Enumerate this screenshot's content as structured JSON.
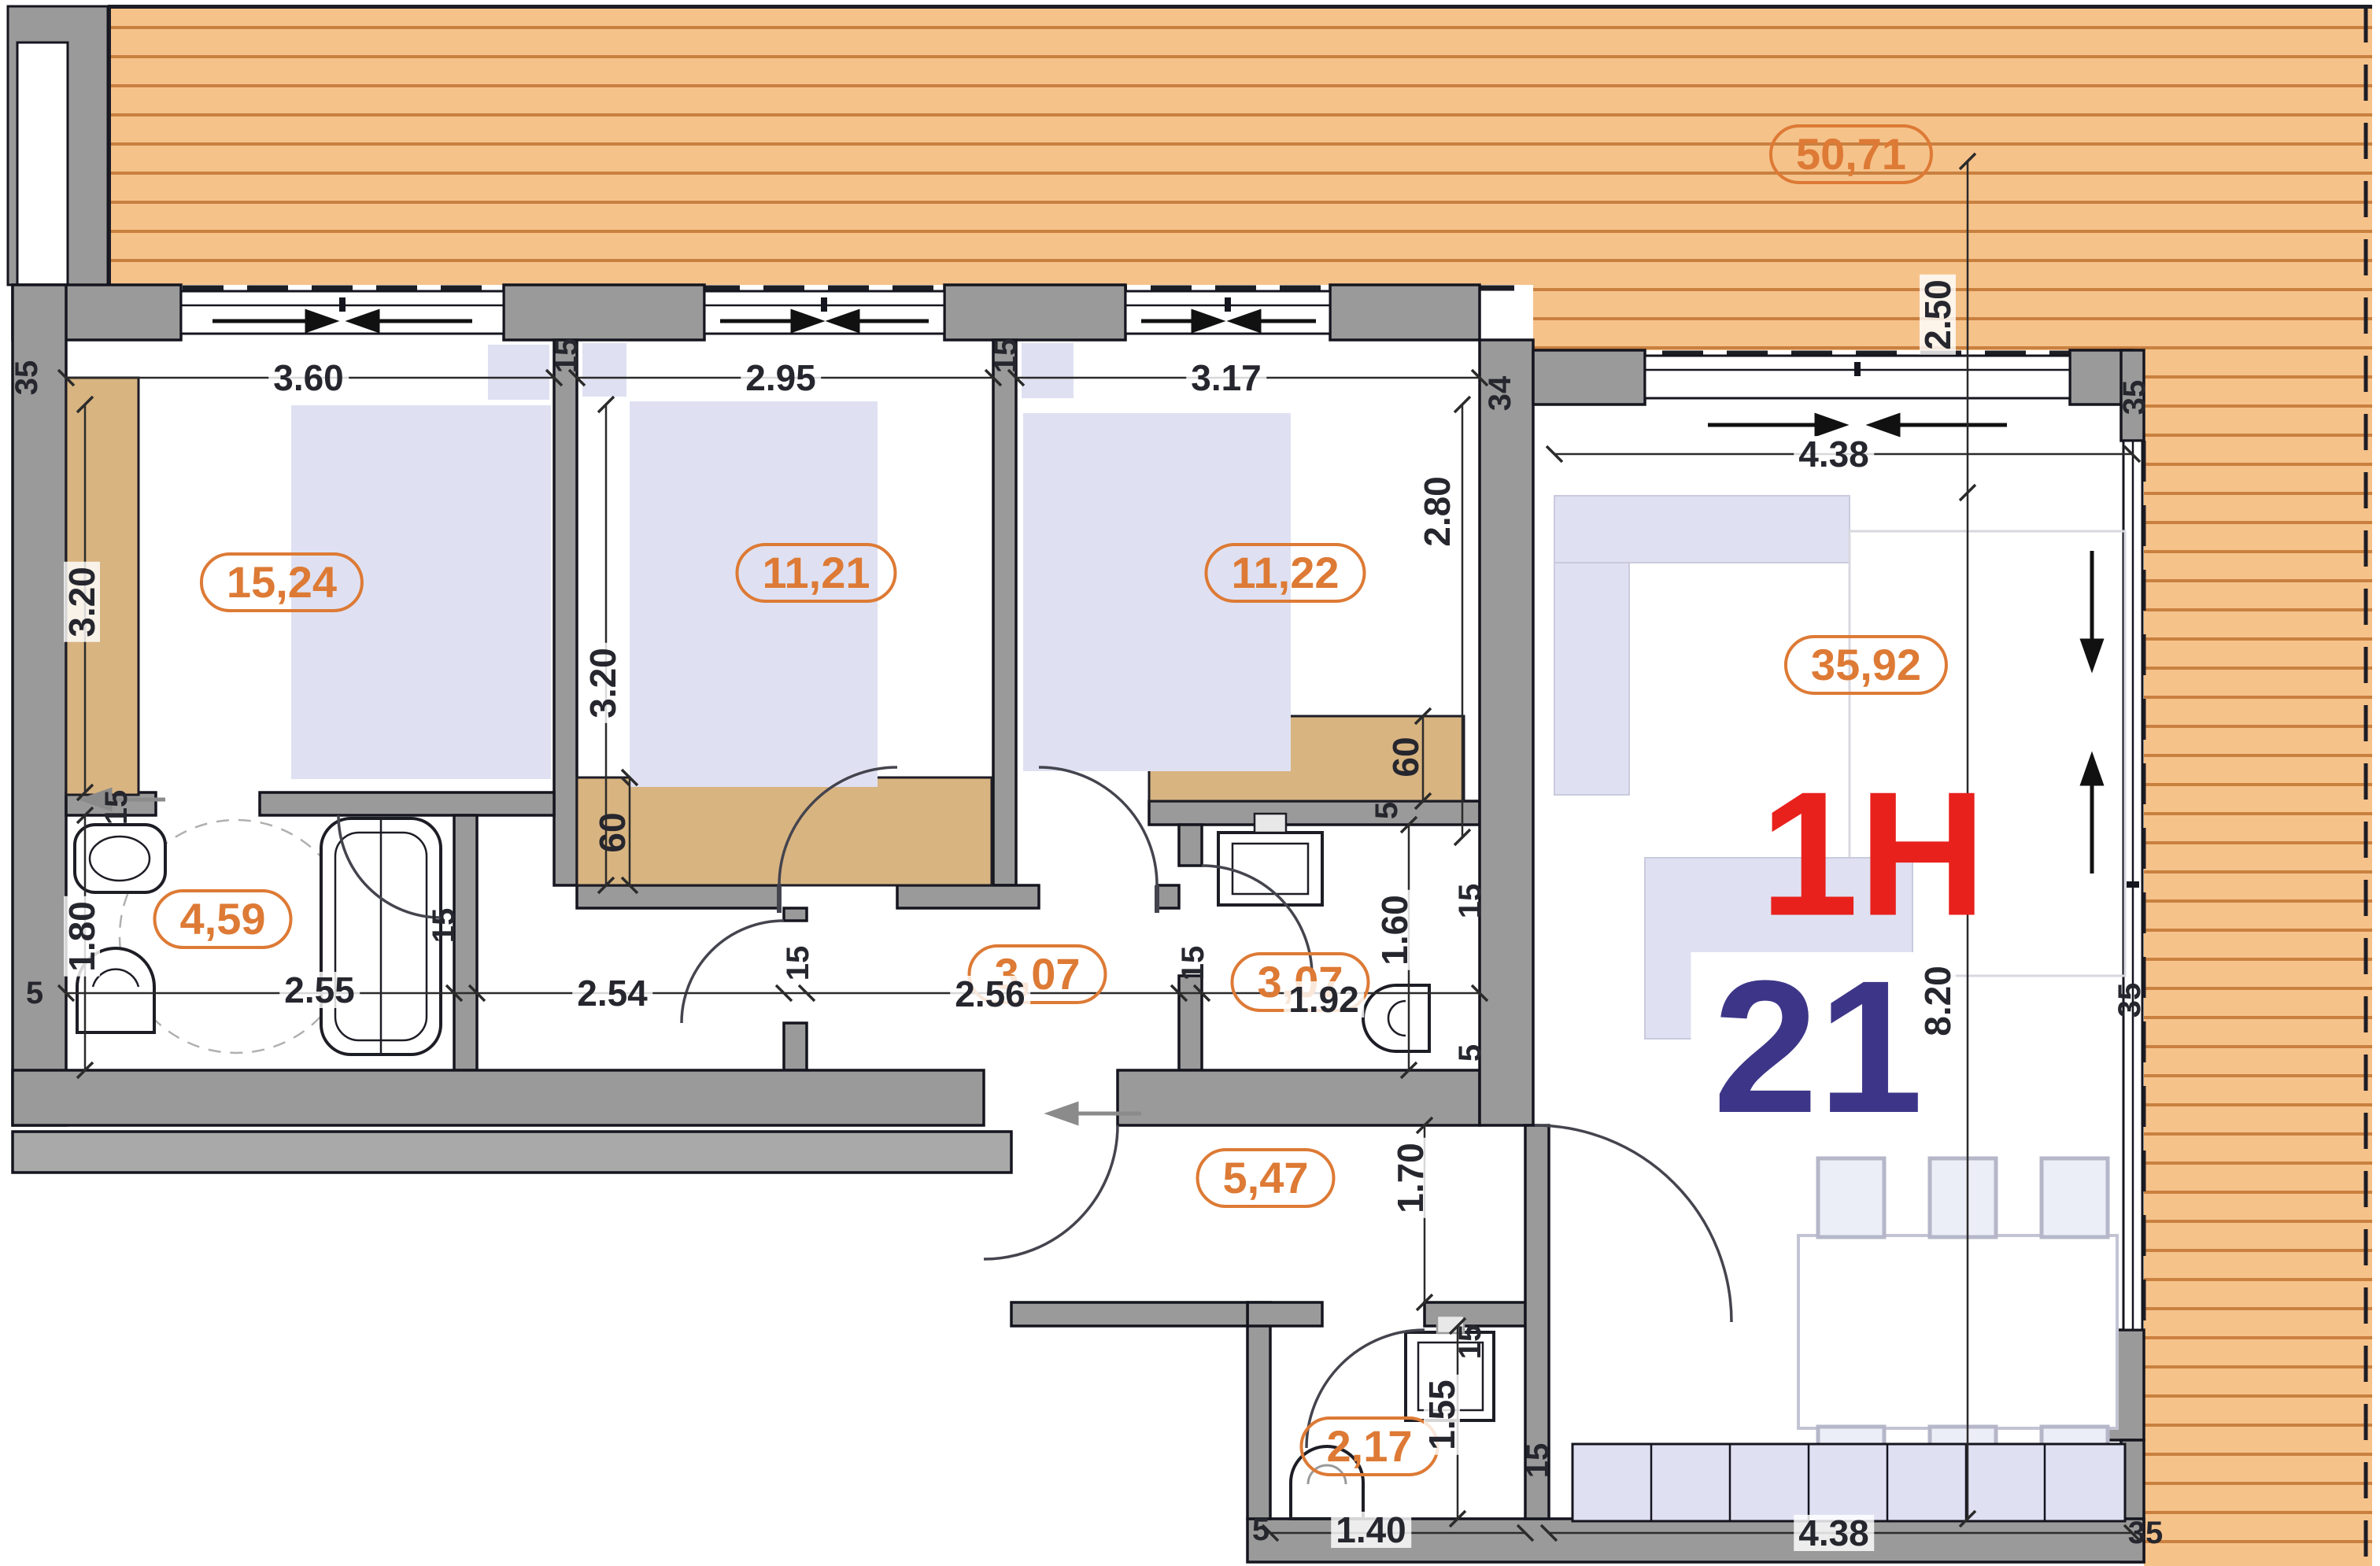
{
  "unit": {
    "type": "1H",
    "number": "21"
  },
  "areas": {
    "terrace": "50,71",
    "bedroom1": "15,24",
    "bedroom2": "11,21",
    "bedroom3": "11,22",
    "living": "35,92",
    "bath1": "4,59",
    "hall": "3,07",
    "bath2": "3,07",
    "entry": "5,47",
    "wc": "2,17"
  },
  "dims": {
    "terrace_depth": "2.50",
    "bedroom1_w": "3.60",
    "bedroom2_w": "2.95",
    "bedroom3_w": "3.17",
    "living_w_top": "4.38",
    "living_d_top": "2.80",
    "bedroom1_h": "3.20",
    "bedroom2_h": "3.20",
    "living_h": "8.20",
    "bath1_h": "1.80",
    "bath1_w": "2.55",
    "corridor_w": "2.54",
    "hall_w": "2.56",
    "bath2_w": "1.92",
    "bath2_h": "1.60",
    "entry_h": "1.70",
    "wc_h": "1.55",
    "wc_w": "1.40",
    "living_w_bottom": "4.38",
    "desk_depth": "60",
    "wardrobe_depth": "60"
  },
  "wall_labels": {
    "t35": "35",
    "t34": "34",
    "t15": "15",
    "t5": "5"
  },
  "colors": {
    "accent_orange": "#dd7a35",
    "unit_red": "#e8211d",
    "unit_navy": "#3d3688",
    "wall_gray": "#9a9a9a",
    "deck_fill": "#f5c28a",
    "deck_line": "#c9803f",
    "furniture_lavender": "#dfe1f2",
    "wood_tan": "#d8b481"
  }
}
